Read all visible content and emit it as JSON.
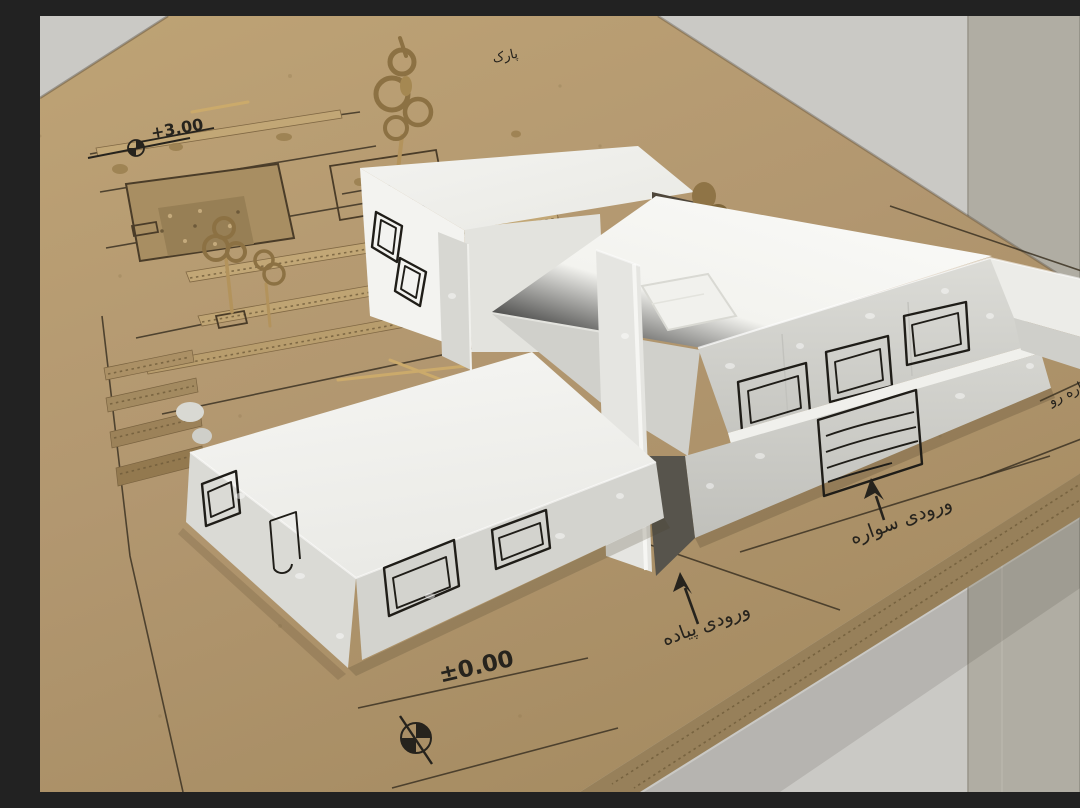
{
  "meta": {
    "description": "Photograph of a handmade architectural massing model: white foam-board buildings with hand-drawn windows on a corrugated cardboard site base, annotated in Persian marker",
    "image_width": 1080,
    "image_height": 776
  },
  "annotations": {
    "level_upper": "+3.00",
    "level_ground": "±0.00",
    "entrance_pedestrian": "ورودی پیاده",
    "entrance_vehicular": "ورودی سواره",
    "park": "پارک",
    "road": "سواره رو"
  },
  "objects": {
    "base": "corrugated cardboard site board with drawn plan lines",
    "buildings": [
      "upper rear block",
      "main block with sloped roof",
      "low front slab"
    ],
    "site_elements": [
      "twisted cardboard trees",
      "parking court with pool",
      "cardboard hedge strips",
      "wooden sticks",
      "terraced cardboard stack"
    ],
    "drawings": [
      "hand-drawn windows",
      "louver grille",
      "benchmark level symbols",
      "entrance arrows"
    ]
  },
  "colors": {
    "wall_light": "#cac9c5",
    "wall_mid": "#b0ada3",
    "wall_dark": "#a3a096",
    "cardboard": "#b39970",
    "cardboard_edge": "#97805a",
    "foam": "#d8d8d3",
    "paper": "#f8f8f5",
    "ink": "#26231d"
  }
}
